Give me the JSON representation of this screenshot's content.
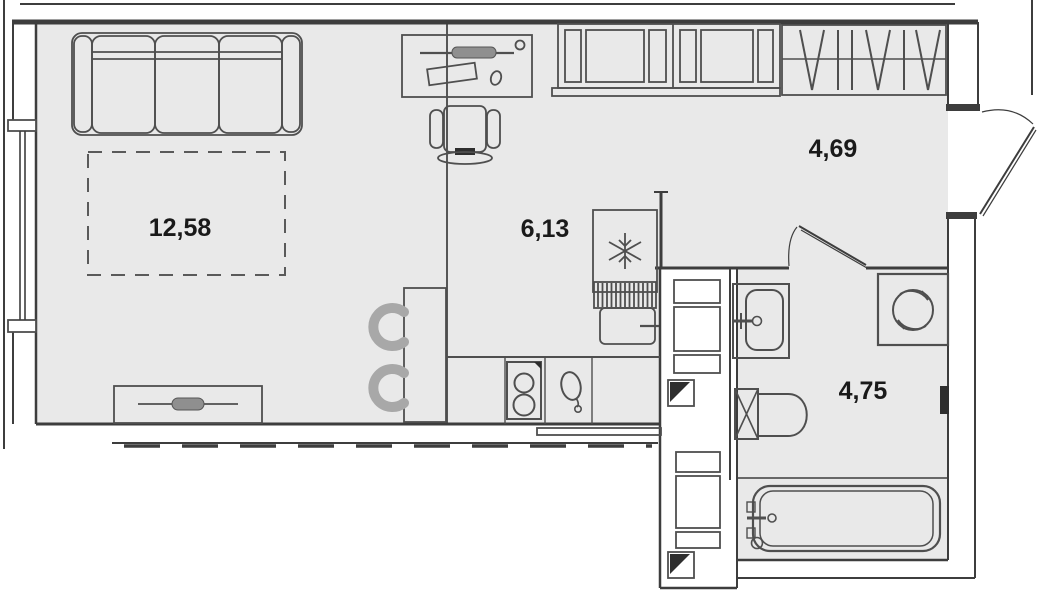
{
  "plan": {
    "type": "apartment-floor-plan",
    "rooms": [
      {
        "name": "living-room",
        "area": "12,58"
      },
      {
        "name": "kitchen",
        "area": "6,13"
      },
      {
        "name": "hallway",
        "area": "4,69"
      },
      {
        "name": "bathroom",
        "area": "4,75"
      }
    ],
    "furniture": [
      "sofa",
      "fold-out-bed",
      "tv-stand",
      "desk",
      "desk-chair",
      "dining-table",
      "dining-chairs",
      "kitchen-upper-cabinets",
      "kitchen-counter",
      "stove",
      "kitchen-sink",
      "refrigerator",
      "dish-dryer",
      "base-cabinet",
      "wardrobe-hangers",
      "entrance-door",
      "bathroom-door",
      "washbasin",
      "toilet",
      "washing-machine",
      "bathtub",
      "ventilation-shaft",
      "radiator",
      "window"
    ],
    "colors": {
      "floor": "#e9e9e9",
      "wall": "#3d3d3d",
      "furniture": "#4f4f4f",
      "chair": "#a8a8a8",
      "label": "#1a1a1a",
      "background": "#ffffff"
    }
  }
}
